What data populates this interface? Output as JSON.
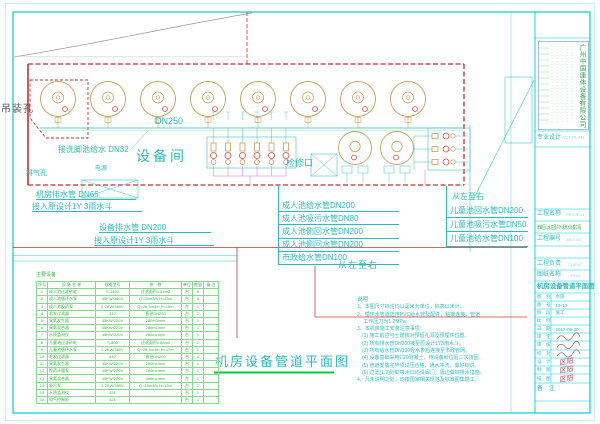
{
  "plan": {
    "hoist_hole": "吊装孔",
    "main_pipe": "DN250",
    "footwash_pipe": "接洗脚池给水 DN32",
    "room": "设备间",
    "power": "电源",
    "vent_hole": "排气孔",
    "access_hatch": "检修口",
    "drain_labels": [
      "机房排水管 DN65",
      "接入原设计1Y 3雨水斗",
      "设备排水管 DN200",
      "接入原设计1Y 3雨水斗"
    ],
    "adult_pipe_labels": [
      "成人池给水管DN200",
      "成人池吸污水管DN80",
      "成人池侧回水管DN200",
      "成人池侧回水管DN200",
      "市政给水管DN100"
    ],
    "left_to_right_mid": "从左至右",
    "left_to_right_right": "从左至右",
    "child_pipe_labels": [
      "儿童池回水管DN200",
      "儿童池吸污水管DN50",
      "儿童池给水管DN100"
    ],
    "plan_title": "机房设备管道平面图"
  },
  "notes": {
    "title": "说明",
    "lines": [
      "1、本图尺寸标注均以毫米为单位，标高以米计。",
      "2、循环水管道选用PVC给水管及配件，粘接连接，管道",
      "　 工作压力为1.2MPa。",
      "3、本机房施工安装注意事项：",
      "　(1) 施工前应与土建核对预留孔洞及预埋件位置。",
      "　(2) 所有排水管DN200接至原设计1Y3雨水斗。",
      "　(3) 所有给水管DN100经水表后连接至市政管网。",
      "　(4) 设备基础采用C20混凝土，待设备就位后二次浇固。",
      "　(5) 管道安装完毕须试压合格，通水冲洗，做好标识。",
      "　(6) 过滤(1.2)砂缸吸水口均设阀门，周边做好排水措施。",
      "4、凡未说明之处，均按国家相关规范及标准图集施工。"
    ]
  },
  "equipment_table": {
    "title": "主要设备",
    "headers": [
      "序号",
      "设 备 名 称",
      "规格型号",
      "参　数",
      "单位",
      "数量",
      "备 注"
    ],
    "rows": [
      {
        "no": "1",
        "name": "成人池过滤砂缸",
        "model": "S-1400",
        "param": "过滤面积1.54m2",
        "unit": "台",
        "qty": "5",
        "rm": ""
      },
      {
        "no": "2",
        "name": "成人池循环水泵",
        "model": "45KW/380V",
        "param": "Q=50m3/h,H=23m",
        "unit": "台",
        "qty": "5",
        "rm": ""
      },
      {
        "no": "3",
        "name": "成人池投药泵",
        "model": "2.2KW/380V",
        "param": "Q=28.3m3/h,H=18m",
        "unit": "台",
        "qty": "1",
        "rm": ""
      },
      {
        "no": "4",
        "name": "毛发过滤器",
        "model": "442",
        "param": "直径DN250",
        "unit": "台",
        "qty": "1",
        "rm": ""
      },
      {
        "no": "5",
        "name": "臭氧发生器",
        "model": "45KW/220V",
        "param": "280m3/min",
        "unit": "台",
        "qty": "1",
        "rm": ""
      },
      {
        "no": "6",
        "name": "臭氧混合器",
        "model": "45KW/220V",
        "param": "280mL/min",
        "unit": "台",
        "qty": "1",
        "rm": ""
      },
      {
        "no": "7",
        "name": "水质监测仪",
        "model": "45KW/220V",
        "param": "280mL/min",
        "unit": "台",
        "qty": "1",
        "rm": ""
      },
      {
        "no": "8",
        "name": "儿童池过滤砂缸",
        "model": "S-800",
        "param": "过滤面积0.68m2",
        "unit": "台",
        "qty": "2",
        "rm": ""
      },
      {
        "no": "9",
        "name": "儿童池循环水泵",
        "model": "2.2KW/380V",
        "param": "Q=28.3m3/h,H=17m",
        "unit": "台",
        "qty": "2",
        "rm": ""
      },
      {
        "no": "10",
        "name": "毛发过滤器",
        "model": "442",
        "param": "直径DN200",
        "unit": "台",
        "qty": "1",
        "rm": ""
      },
      {
        "no": "11",
        "name": "臭氧发生器",
        "model": "45KW/220V",
        "param": "280mL/min",
        "unit": "台",
        "qty": "1",
        "rm": ""
      },
      {
        "no": "12",
        "name": "投药计量泵",
        "model": "45KW/220V",
        "param": "280mL/min",
        "unit": "台",
        "qty": "1",
        "rm": ""
      },
      {
        "no": "13",
        "name": "臭氧混合器",
        "model": "45KW/220V",
        "param": "380mL/min",
        "unit": "台",
        "qty": "1",
        "rm": ""
      },
      {
        "no": "14",
        "name": "吸污泵",
        "model": "2.2KW/380V",
        "param": "Q=10m3/h,H=15m",
        "unit": "台",
        "qty": "1",
        "rm": ""
      },
      {
        "no": "15",
        "name": "水质监测仪",
        "model": "431",
        "param": "",
        "unit": "台",
        "qty": "1",
        "rm": ""
      },
      {
        "no": "16",
        "name": "电气控制柜",
        "model": "421",
        "param": "",
        "unit": "台",
        "qty": "1",
        "rm": ""
      }
    ]
  },
  "title_block": {
    "company": "广州中国康体设备有限公司",
    "design_label": "专业设计",
    "design_value": "ACT PLAN",
    "project_label": "工程名称",
    "project_en": "PROJECT",
    "project_name": "增城区山水庄园户外泳池水处理工程",
    "number_label": "工程编号",
    "number_value": "0407-80",
    "manager_label": "工程负责",
    "manager_en": "CLIENT",
    "sheetname_label": "图纸名称",
    "sheetname_en": "TITLE",
    "drawing_title": "机房设备管道平面图",
    "info_rows": [
      {
        "label": "图　别",
        "value": "水施"
      },
      {
        "label": "图　号",
        "value": "19-10"
      },
      {
        "label": "阶　段",
        "value": "施工"
      },
      {
        "label": "比　例",
        "value": ""
      },
      {
        "label": "日　期",
        "value": "2013-09-30"
      }
    ],
    "sign_rows": [
      {
        "label": "审　定",
        "value": ""
      },
      {
        "label": "审　核",
        "value": ""
      },
      {
        "label": "校　对",
        "value": ""
      },
      {
        "label": "设　计",
        "value": "区阳"
      },
      {
        "label": "制　图",
        "value": "区阳"
      },
      {
        "label": "描　图",
        "value": "区阳"
      }
    ],
    "remark_label": "备　注"
  }
}
